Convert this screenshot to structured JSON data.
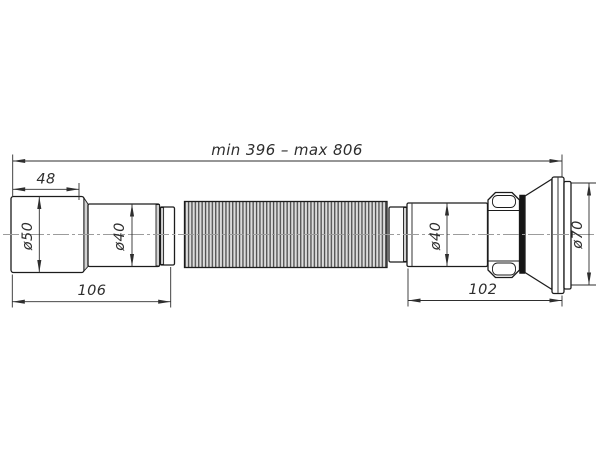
{
  "drawing": {
    "overall_label": "min 396 – max 806",
    "dims": {
      "socket_depth": "48",
      "inlet_diameter": "ø50",
      "left_pipe_diameter": "ø40",
      "right_pipe_diameter": "ø40",
      "outlet_diameter": "ø70",
      "left_section_length": "106",
      "right_section_length": "102"
    },
    "colors": {
      "background": "#ffffff",
      "line": "#1c1c1c",
      "dim": "#2e2e2e",
      "centerline": "#9c9c9c",
      "corr_bg": "#dcdcdc",
      "corr_rib": "#4d4d4d",
      "shade": "#d2d2d2",
      "gasket": "#161616"
    }
  }
}
